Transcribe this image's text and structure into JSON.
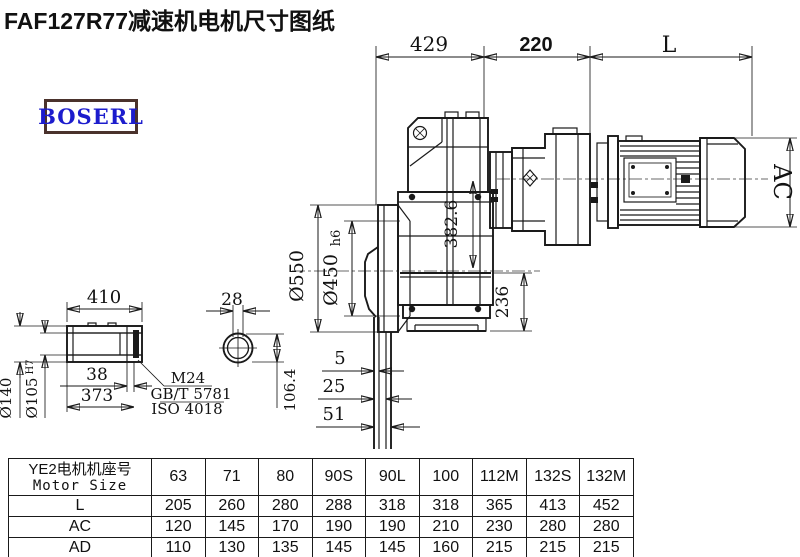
{
  "title": "FAF127R77减速机电机尺寸图纸",
  "logo": "BOSERL",
  "dims": {
    "top1": "429",
    "top2": "220",
    "top3": "L",
    "ac": "AC",
    "d550": "Ø550",
    "d450": "Ø450",
    "d450_tol": "h6",
    "height1": "382.6",
    "height2": "236",
    "off1": "5",
    "off2": "25",
    "off3": "51",
    "shaft_len": "410",
    "key_w": "28",
    "d140": "Ø140",
    "d105": "Ø105",
    "d105_tol": "H7",
    "groove": "38",
    "shaft_inner": "373",
    "bolt": "M24",
    "std1": "GB/T 5781",
    "std2": "ISO 4018",
    "key_h": "106.4"
  },
  "table": {
    "header_cn": "YE2电机机座号",
    "header_en": "Motor Size",
    "columns": [
      "63",
      "71",
      "80",
      "90S",
      "90L",
      "100",
      "112M",
      "132S",
      "132M"
    ],
    "rows": [
      {
        "label": "L",
        "values": [
          "205",
          "260",
          "280",
          "288",
          "318",
          "318",
          "365",
          "413",
          "452"
        ]
      },
      {
        "label": "AC",
        "values": [
          "120",
          "145",
          "170",
          "190",
          "190",
          "210",
          "230",
          "280",
          "280"
        ]
      },
      {
        "label": "AD",
        "values": [
          "110",
          "130",
          "135",
          "145",
          "145",
          "160",
          "215",
          "215",
          "215"
        ]
      }
    ]
  }
}
